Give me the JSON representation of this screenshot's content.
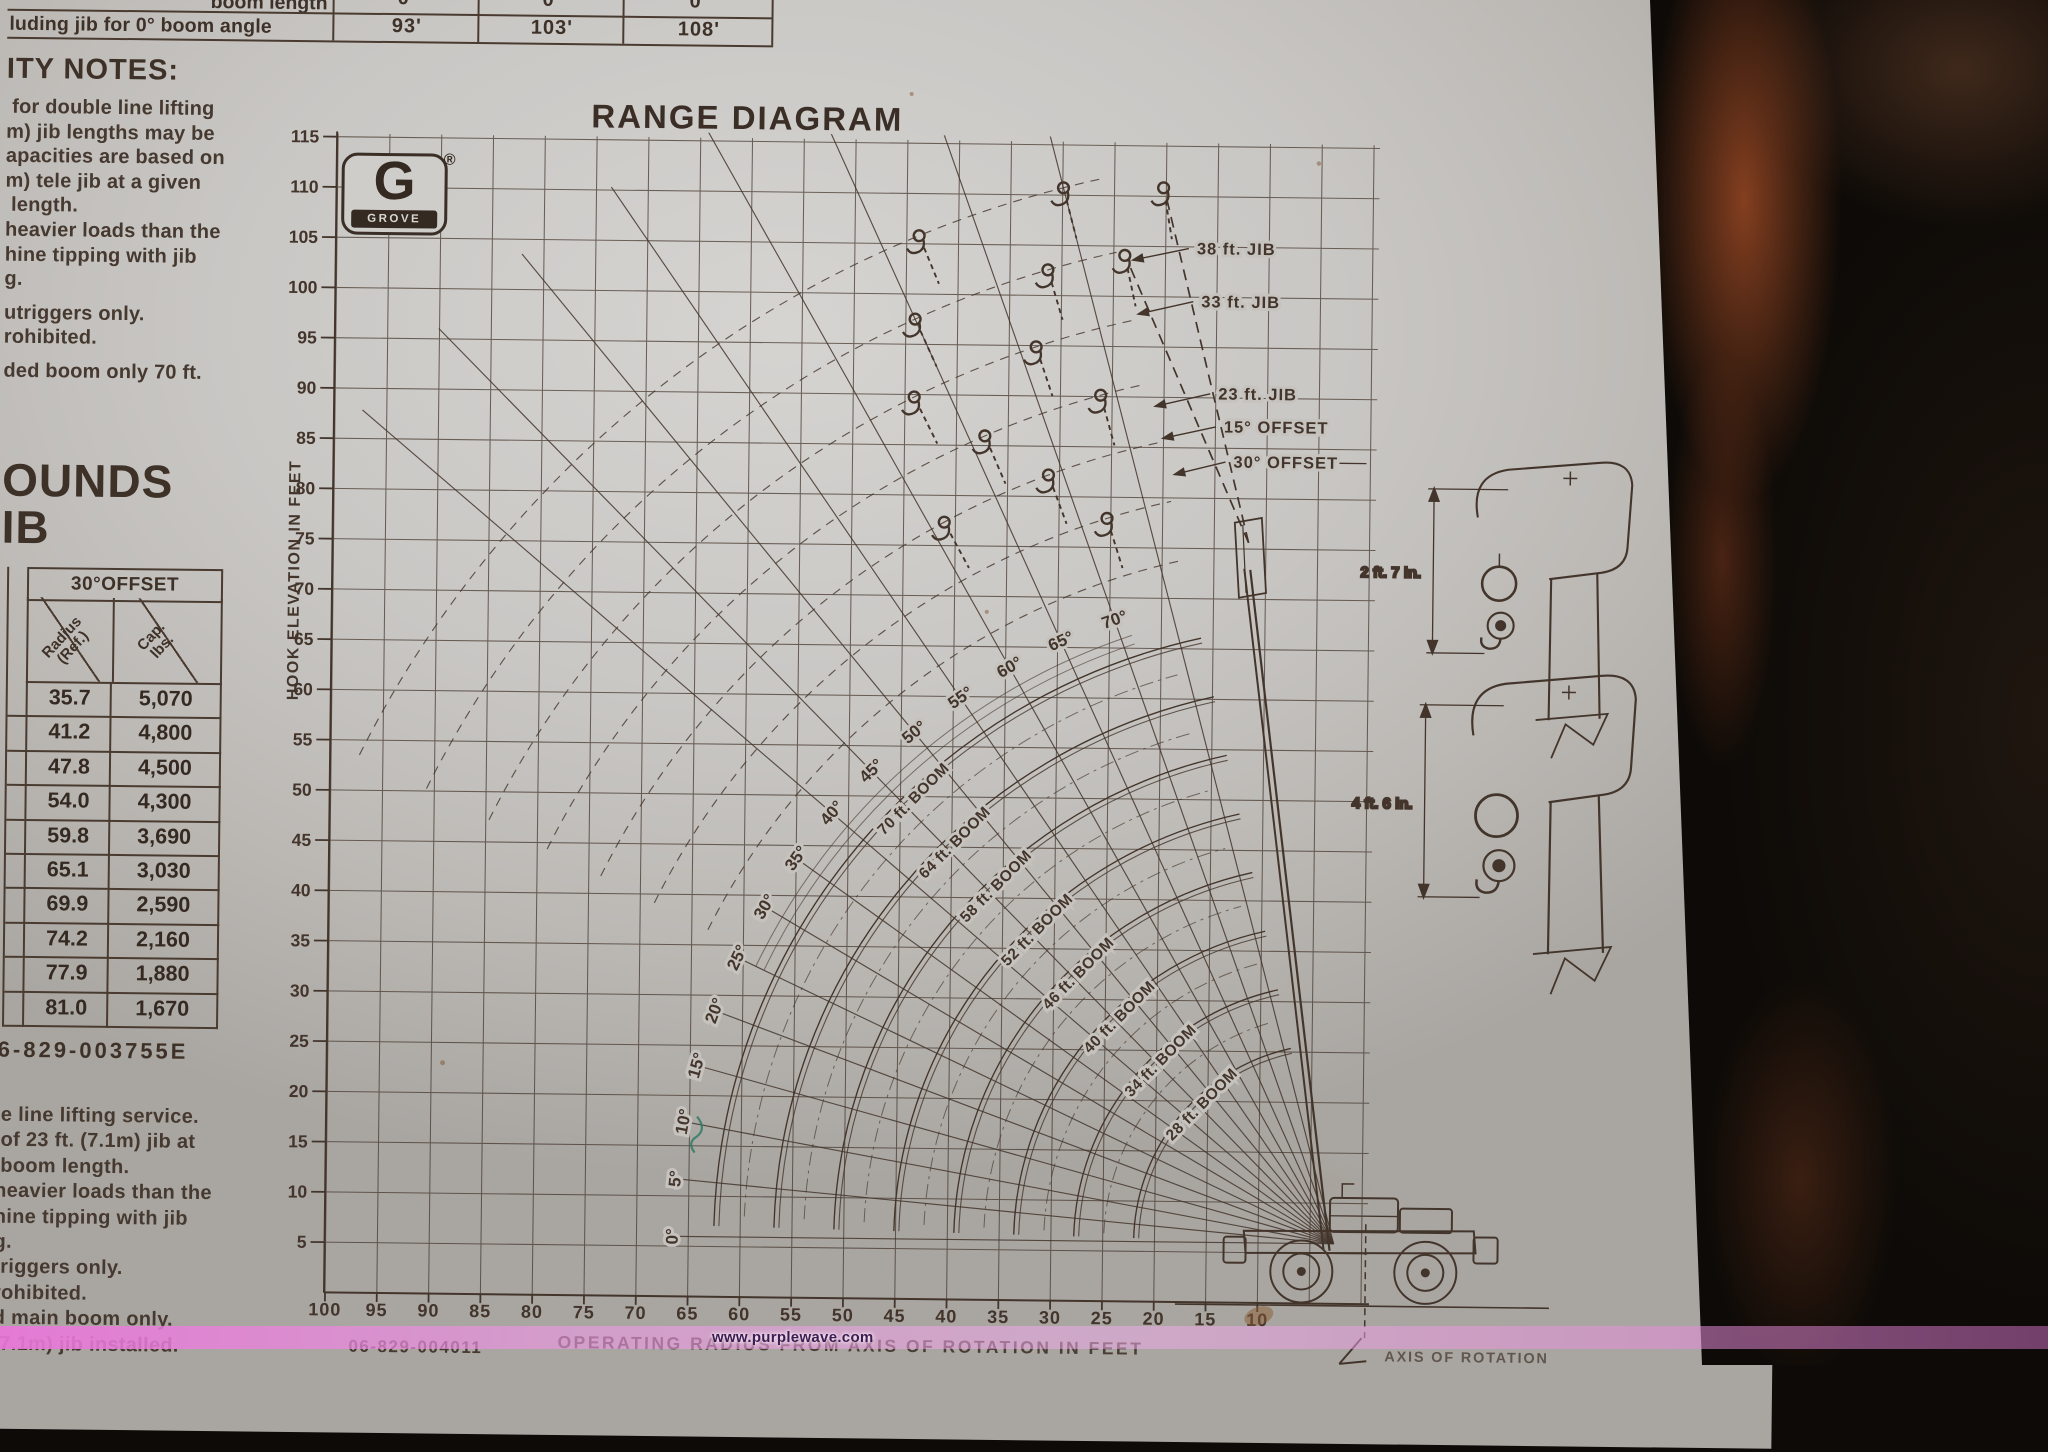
{
  "photo": {
    "watermark": "www.purplewave.com"
  },
  "top_table": {
    "row1_label": "boom length",
    "row2_label": "luding jib for 0° boom angle",
    "columns": [
      {
        "deg": "0°",
        "len": "93'"
      },
      {
        "deg": "0°",
        "len": "103'"
      },
      {
        "deg": "0°",
        "len": "108'"
      }
    ]
  },
  "notes_top": {
    "heading": "ITY NOTES:",
    "paragraphs": [
      [
        " for double line lifting",
        "m) jib lengths may be",
        "apacities are based on",
        "m) tele jib at a given",
        " length.",
        "heavier loads than the",
        "hine tipping with jib",
        "g."
      ],
      [
        "utriggers only.",
        "rohibited."
      ],
      [
        "ded boom only 70 ft."
      ]
    ]
  },
  "pounds_heading": {
    "line1": "OUNDS",
    "line2": "IB"
  },
  "offset_table": {
    "title": "30°OFFSET",
    "header": {
      "c1": [
        "Radius",
        "(Ref.)"
      ],
      "c2": [
        "Cap.",
        "lbs."
      ]
    },
    "rows": [
      [
        "35.7",
        "5,070"
      ],
      [
        "41.2",
        "4,800"
      ],
      [
        "47.8",
        "4,500"
      ],
      [
        "54.0",
        "4,300"
      ],
      [
        "59.8",
        "3,690"
      ],
      [
        "65.1",
        "3,030"
      ],
      [
        "69.9",
        "2,590"
      ],
      [
        "74.2",
        "2,160"
      ],
      [
        "77.9",
        "1,880"
      ],
      [
        "81.0",
        "1,670"
      ]
    ]
  },
  "part_number_left": "6-829-003755E",
  "notes_bottom": {
    "lines": [
      "le line lifting service.",
      " of 23 ft. (7.1m) jib at",
      " boom length.",
      "heavier loads than the",
      "hine tipping with jib",
      "g.",
      "triggers only.",
      "rohibited.",
      "d main boom only.",
      "(7.1m) jib installed."
    ]
  },
  "part_number_bottom": "06-829-004011",
  "chart_data": {
    "type": "line",
    "title": "RANGE DIAGRAM",
    "xlabel": "OPERATING RADIUS FROM AXIS OF ROTATION IN FEET",
    "ylabel": "HOOK ELEVATION IN FEET",
    "x_ticks": [
      100,
      95,
      90,
      85,
      80,
      75,
      70,
      65,
      60,
      55,
      50,
      45,
      40,
      35,
      30,
      25,
      20,
      15,
      10
    ],
    "y_ticks": [
      115,
      110,
      105,
      100,
      95,
      90,
      85,
      80,
      75,
      70,
      65,
      60,
      55,
      50,
      45,
      40,
      35,
      30,
      25,
      20,
      15,
      10,
      5
    ],
    "xlim": [
      105,
      0
    ],
    "ylim": [
      0,
      116
    ],
    "grid": true,
    "boom_angle_labels": [
      "0°",
      "5°",
      "10°",
      "15°",
      "20°",
      "25°",
      "30°",
      "35°",
      "40°",
      "45°",
      "50°",
      "55°",
      "60°",
      "65°",
      "70°"
    ],
    "boom_lengths_ft": [
      70,
      64,
      58,
      52,
      46,
      40,
      34,
      28
    ],
    "boom_length_labels": [
      "70 ft. BOOM",
      "64 ft. BOOM",
      "58 ft. BOOM",
      "52 ft. BOOM",
      "46 ft. BOOM",
      "40 ft. BOOM",
      "34 ft. BOOM",
      "28 ft. BOOM"
    ],
    "jib_curve_labels": [
      "38 ft. JIB",
      "33 ft. JIB",
      "23 ft. JIB",
      "15° OFFSET",
      "30° OFFSET"
    ],
    "logo": {
      "letter": "G",
      "name": "GROVE",
      "registered": "®"
    },
    "detail_dimensions": [
      "2 ft. 7 in.",
      "4 ft. 6 in."
    ],
    "axis_of_rotation_label": "AXIS OF ROTATION"
  }
}
